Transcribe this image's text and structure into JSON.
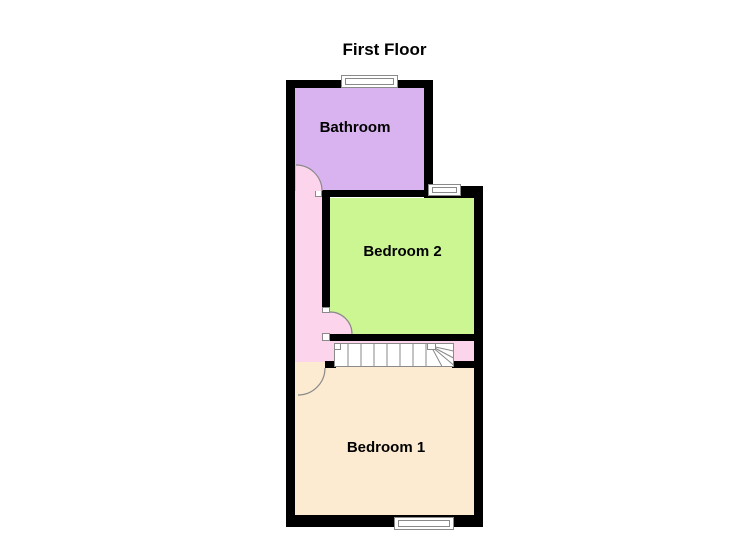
{
  "title": "First Floor",
  "rooms": {
    "bathroom": {
      "label": "Bathroom",
      "color": "#d9b3f0"
    },
    "bedroom2": {
      "label": "Bedroom 2",
      "color": "#cbf692"
    },
    "bedroom1": {
      "label": "Bedroom 1",
      "color": "#fcebd0"
    },
    "landing": {
      "color": "#fcd4eb"
    }
  },
  "colors": {
    "wall": "#000000",
    "background": "#ffffff",
    "text": "#000000",
    "fixture_fill": "#ffffff",
    "fixture_stroke": "#8a8a8a"
  },
  "features": {
    "windows": 3,
    "doors": 3,
    "staircase": "winder-stairs"
  }
}
